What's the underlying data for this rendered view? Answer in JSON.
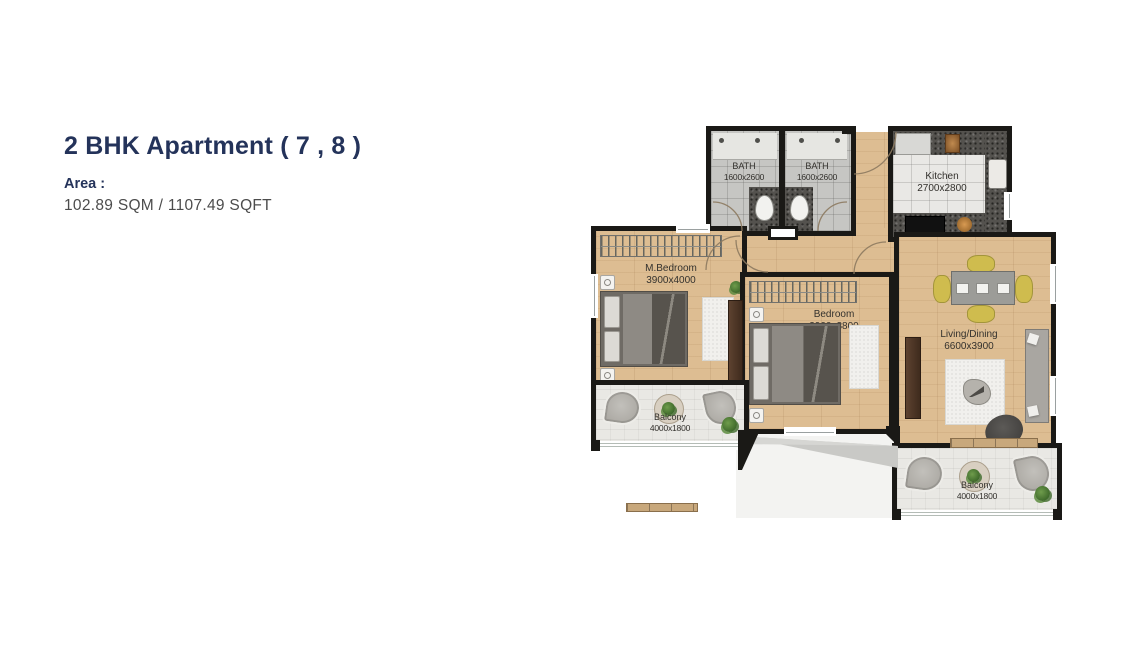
{
  "header": {
    "title": "2 BHK Apartment ( 7 , 8 )",
    "area_label": "Area :",
    "area_value": "102.89 SQM / 1107.49 SQFT"
  },
  "floorplan": {
    "rooms": [
      {
        "name": "BATH",
        "dims": "1600x2600"
      },
      {
        "name": "BATH",
        "dims": "1600x2600"
      },
      {
        "name": "Kitchen",
        "dims": "2700x2800"
      },
      {
        "name": "M.Bedroom",
        "dims": "3900x4000"
      },
      {
        "name": "Bedroom",
        "dims": "3900x3800"
      },
      {
        "name": "Living/Dining",
        "dims": "6600x3900"
      },
      {
        "name": "Balcony",
        "dims": "4000x1800"
      },
      {
        "name": "Balcony",
        "dims": "4000x1800"
      }
    ],
    "colors": {
      "title_navy": "#24335a",
      "body_text": "#4c4c4c",
      "wall": "#1a1916",
      "wood_floor": "#ddbd92",
      "bath_tile": "#c6c6c3",
      "kitchen_floor": "#e9e8e5",
      "balcony_floor": "#e9e8e4",
      "counter_granite": "#54524e",
      "dining_chair_yellow": "#cfbc4e",
      "door_arc_brown": "#8d7a60"
    }
  }
}
